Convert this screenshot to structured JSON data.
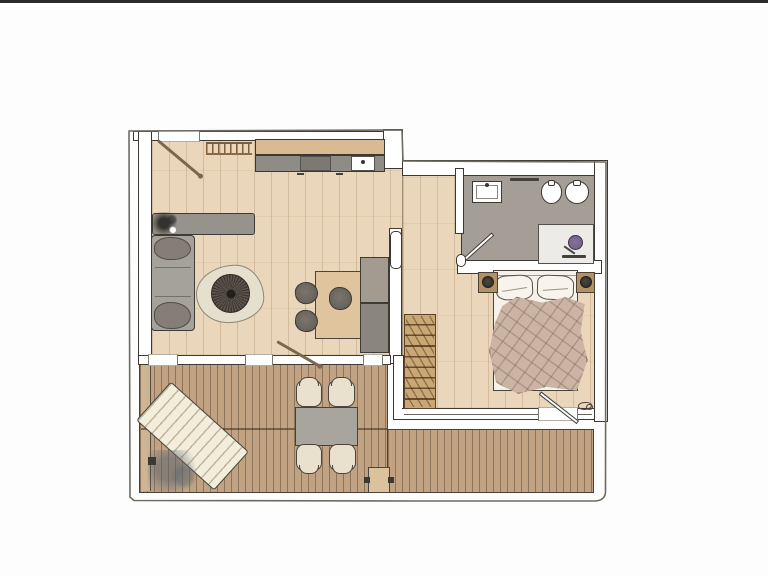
{
  "meta": {
    "description": "hand-drawn color floor plan of a one-bedroom apartment with terrace deck",
    "no_visible_text": true
  },
  "colors": {
    "ink": "#3c3833",
    "pencil": "#6f6b62",
    "band": "#2c2b29",
    "floor": "#ead7bb",
    "bath": "#a59e96",
    "deck": "#c1a384",
    "deck_light": "#d0b795",
    "counter": "#d8ba93",
    "cabinet": "#8f8c87",
    "cooktop": "#7c7973",
    "gray_furn": "#96938d",
    "sofa": "#a5a19b",
    "cushion": "#847e76",
    "rug": "#e5dfcd",
    "wood_table": "#dfc49e",
    "cab_up": "#a39a90",
    "cab_low": "#8a857e",
    "wardrobe": "#c9a876",
    "wardrobe_line": "#5b4127",
    "bed": "#f6f2ea",
    "blanket": "#cbb4a4",
    "nightstand": "#b29165",
    "shower": "#edebe7",
    "shower_head": "#6f5d80",
    "out_chair": "#e9e1ce",
    "out_table": "#a8a49e",
    "lounger": "#f3eddc",
    "step": "#dcc29c",
    "door_wood": "#7a6750"
  },
  "paths": {
    "building_outline": "M129,131 L130,497 L134,500.5 L420,501 L594,501 Q605,501 605.5,492 L606,162 L403,161 L402,130 Z"
  },
  "scene": {
    "items": [
      {
        "name": "living-room-floor",
        "cls": "floor-wood",
        "x": 151,
        "y": 139,
        "w": 252,
        "h": 217
      },
      {
        "name": "bedroom-hall-floor",
        "cls": "floor-wood",
        "x": 402,
        "y": 175,
        "w": 193,
        "h": 234
      },
      {
        "name": "bathroom-floor",
        "cls": "floor-bath",
        "x": 461,
        "y": 175,
        "w": 134,
        "h": 90
      },
      {
        "name": "deck-left",
        "cls": "deck",
        "x": 139,
        "y": 363,
        "w": 249,
        "h": 130
      },
      {
        "name": "deck-right",
        "cls": "deck",
        "x": 387,
        "y": 429,
        "w": 207,
        "h": 64
      },
      {
        "name": "deck-margin-board",
        "cls": "deck-margin",
        "x": 141,
        "y": 365,
        "w": 10,
        "h": 126
      },
      {
        "name": "deck-seam",
        "cls": "seam-line",
        "x": 141,
        "y": 428,
        "w": 246,
        "h": 2
      },
      {
        "name": "wall-top-living",
        "cls": "wall",
        "x": 133,
        "y": 131,
        "w": 270,
        "h": 10
      },
      {
        "name": "entry-opening",
        "cls": "wall-gap",
        "x": 158,
        "y": 130,
        "w": 42,
        "h": 12
      },
      {
        "name": "wall-left",
        "cls": "wall",
        "x": 138,
        "y": 131,
        "w": 14,
        "h": 233
      },
      {
        "name": "wall-step-top",
        "cls": "wall",
        "x": 383,
        "y": 129,
        "w": 20,
        "h": 40
      },
      {
        "name": "wall-top-right",
        "cls": "wall",
        "x": 402,
        "y": 160,
        "w": 206,
        "h": 16
      },
      {
        "name": "wall-east",
        "cls": "wall",
        "x": 594,
        "y": 160,
        "w": 14,
        "h": 262
      },
      {
        "name": "wall-bathroom-west",
        "cls": "wall",
        "x": 455,
        "y": 168,
        "w": 9,
        "h": 66
      },
      {
        "name": "wall-bathroom-south",
        "cls": "wall",
        "x": 457,
        "y": 260,
        "w": 145,
        "h": 14
      },
      {
        "name": "wall-living-east",
        "cls": "wall",
        "x": 389,
        "y": 228,
        "w": 13,
        "h": 136
      },
      {
        "name": "wall-bedroom-west",
        "cls": "wall",
        "x": 393,
        "y": 355,
        "w": 11,
        "h": 65
      },
      {
        "name": "wall-living-south",
        "cls": "wall",
        "x": 138,
        "y": 355,
        "w": 253,
        "h": 10
      },
      {
        "name": "window-left",
        "cls": "wall-gap",
        "x": 148,
        "y": 354,
        "w": 30,
        "h": 12
      },
      {
        "name": "window-middle",
        "cls": "wall-gap",
        "x": 245,
        "y": 354,
        "w": 28,
        "h": 12
      },
      {
        "name": "window-right",
        "cls": "wall-gap",
        "x": 363,
        "y": 354,
        "w": 20,
        "h": 12
      },
      {
        "name": "wall-bedroom-south-glazing",
        "cls": "wall-glass",
        "x": 402,
        "y": 408,
        "w": 192,
        "h": 12
      },
      {
        "name": "bedroom-terrace-opening",
        "cls": "wall-gap",
        "x": 538,
        "y": 407,
        "w": 40,
        "h": 14
      },
      {
        "name": "kitchen-counter",
        "cls": "counter",
        "x": 255,
        "y": 139,
        "w": 130,
        "h": 16
      },
      {
        "name": "kitchen-cabinet-front",
        "cls": "cabinet",
        "x": 255,
        "y": 155,
        "w": 130,
        "h": 17
      },
      {
        "name": "kitchen-cooktop",
        "cls": "cooktop",
        "x": 300,
        "y": 156,
        "w": 31,
        "h": 15
      },
      {
        "name": "kitchen-sink",
        "cls": "sink",
        "x": 351,
        "y": 156,
        "w": 24,
        "h": 15
      },
      {
        "name": "cabinet-handle-left",
        "cls": "dash",
        "x": 297,
        "y": 173,
        "w": 7,
        "h": 2
      },
      {
        "name": "cabinet-handle-right",
        "cls": "dash",
        "x": 336,
        "y": 173,
        "w": 7,
        "h": 2
      },
      {
        "name": "coat-rack",
        "cls": "coat-rack",
        "x": 206,
        "y": 142,
        "w": 46,
        "h": 13
      },
      {
        "name": "entry-door-leaf",
        "cls": "door-leaf-wood",
        "x": 158,
        "y": 139,
        "w": 55,
        "h": 3,
        "rot": 40
      },
      {
        "name": "sideboard",
        "cls": "gray-furn",
        "x": 152,
        "y": 213,
        "w": 103,
        "h": 22
      },
      {
        "name": "sideboard-plant",
        "cls": "plant-dark",
        "x": 153,
        "y": 212,
        "w": 26,
        "h": 23
      },
      {
        "name": "sofa",
        "cls": "sofa",
        "x": 151,
        "y": 235,
        "w": 44,
        "h": 96
      },
      {
        "name": "sofa-cushion-top",
        "cls": "cushion",
        "x": 154,
        "y": 237,
        "w": 37,
        "h": 23
      },
      {
        "name": "sofa-cushion-bottom",
        "cls": "cushion",
        "x": 154,
        "y": 302,
        "w": 37,
        "h": 27
      },
      {
        "name": "rug",
        "cls": "rug",
        "x": 196,
        "y": 265,
        "w": 68,
        "h": 58,
        "rot": -3
      },
      {
        "name": "coffee-table",
        "cls": "coffee",
        "x": 211,
        "y": 274,
        "w": 39,
        "h": 39
      },
      {
        "name": "dining-table",
        "cls": "wood-table",
        "x": 315,
        "y": 271,
        "w": 47,
        "h": 68
      },
      {
        "name": "dining-chair-1",
        "cls": "chair-dark",
        "x": 295,
        "y": 282,
        "w": 23,
        "h": 22,
        "rot": -8
      },
      {
        "name": "dining-chair-2",
        "cls": "chair-dark",
        "x": 295,
        "y": 310,
        "w": 23,
        "h": 22,
        "rot": 6
      },
      {
        "name": "dining-chair-3",
        "cls": "chair-dark",
        "x": 329,
        "y": 287,
        "w": 23,
        "h": 23
      },
      {
        "name": "tall-cabinet-upper",
        "cls": "cab-up",
        "x": 360,
        "y": 257,
        "w": 29,
        "h": 46
      },
      {
        "name": "tall-cabinet-lower",
        "cls": "cab-low",
        "x": 360,
        "y": 303,
        "w": 29,
        "h": 50
      },
      {
        "name": "pocket-door",
        "cls": "door-white",
        "x": 390,
        "y": 231,
        "w": 12,
        "h": 38
      },
      {
        "name": "terrace-door-leaf",
        "cls": "door-leaf-wood",
        "x": 277,
        "y": 340,
        "w": 49,
        "h": 3,
        "rot": 30
      },
      {
        "name": "wardrobe-rack",
        "cls": "wardrobe",
        "x": 404,
        "y": 314,
        "w": 32,
        "h": 95
      },
      {
        "name": "bed",
        "cls": "bed",
        "x": 493,
        "y": 270,
        "w": 85,
        "h": 121
      },
      {
        "name": "pillow-left",
        "cls": "pillow",
        "x": 496,
        "y": 275,
        "w": 37,
        "h": 25,
        "rot": -3
      },
      {
        "name": "pillow-right",
        "cls": "pillow",
        "x": 537,
        "y": 275,
        "w": 37,
        "h": 25,
        "rot": 2
      },
      {
        "name": "bed-blanket",
        "cls": "blanket",
        "x": 489,
        "y": 296,
        "w": 98,
        "h": 97,
        "rot": -2
      },
      {
        "name": "nightstand-left",
        "cls": "nightstand",
        "x": 478,
        "y": 272,
        "w": 20,
        "h": 21
      },
      {
        "name": "nightstand-lamp-left",
        "cls": "lamp",
        "x": 482,
        "y": 276,
        "w": 12,
        "h": 12
      },
      {
        "name": "nightstand-right",
        "cls": "nightstand",
        "x": 576,
        "y": 272,
        "w": 19,
        "h": 21
      },
      {
        "name": "nightstand-lamp-right",
        "cls": "lamp",
        "x": 580,
        "y": 276,
        "w": 12,
        "h": 12
      },
      {
        "name": "bedroom-terrace-door-leaf",
        "cls": "door-leaf-white",
        "x": 540,
        "y": 391,
        "w": 48,
        "h": 4,
        "rot": 38
      },
      {
        "name": "door-hardware-mark",
        "cls": "squiggle",
        "x": 578,
        "y": 402,
        "w": 14,
        "h": 8
      },
      {
        "name": "washbasin",
        "cls": "basin",
        "x": 472,
        "y": 181,
        "w": 30,
        "h": 22
      },
      {
        "name": "towel-rail",
        "cls": "dark-dash",
        "x": 510,
        "y": 178,
        "w": 29,
        "h": 3
      },
      {
        "name": "bidet",
        "cls": "fixture-oval",
        "x": 541,
        "y": 181,
        "w": 21,
        "h": 23
      },
      {
        "name": "toilet",
        "cls": "fixture-oval",
        "x": 565,
        "y": 181,
        "w": 24,
        "h": 23
      },
      {
        "name": "shower-tray",
        "cls": "shower",
        "x": 538,
        "y": 224,
        "w": 56,
        "h": 40
      },
      {
        "name": "shower-head",
        "cls": "shower-head",
        "x": 568,
        "y": 235,
        "w": 15,
        "h": 15
      },
      {
        "name": "shower-base-line",
        "cls": "dark-dash",
        "x": 562,
        "y": 255,
        "w": 24,
        "h": 3
      },
      {
        "name": "bathroom-door-leaf",
        "cls": "door-leaf-white",
        "x": 464,
        "y": 258,
        "w": 39,
        "h": 4,
        "rot": -42
      },
      {
        "name": "bathroom-threshold",
        "cls": "door-white",
        "x": 456,
        "y": 254,
        "w": 10,
        "h": 13
      },
      {
        "name": "outdoor-table",
        "cls": "out-table",
        "x": 295,
        "y": 407,
        "w": 63,
        "h": 39
      },
      {
        "name": "outdoor-chair-top-left",
        "cls": "chair-out up",
        "x": 296,
        "y": 380,
        "w": 26,
        "h": 27
      },
      {
        "name": "outdoor-chair-top-right",
        "cls": "chair-out up",
        "x": 328,
        "y": 380,
        "w": 27,
        "h": 27
      },
      {
        "name": "outdoor-chair-bottom-left",
        "cls": "chair-out dn",
        "x": 296,
        "y": 444,
        "w": 26,
        "h": 27
      },
      {
        "name": "outdoor-chair-bottom-right",
        "cls": "chair-out dn",
        "x": 329,
        "y": 444,
        "w": 27,
        "h": 27
      },
      {
        "name": "sun-lounger",
        "cls": "lounger",
        "x": 140,
        "y": 410,
        "w": 105,
        "h": 52,
        "rot": 42
      },
      {
        "name": "deck-plant",
        "cls": "plant-soft",
        "x": 148,
        "y": 450,
        "w": 52,
        "h": 42
      },
      {
        "name": "deck-plant-pot",
        "cls": "dot-dark",
        "x": 148,
        "y": 457,
        "w": 8,
        "h": 8
      },
      {
        "name": "deck-step",
        "cls": "step",
        "x": 368,
        "y": 467,
        "w": 22,
        "h": 26
      },
      {
        "name": "step-dot-left",
        "cls": "dot-dark",
        "x": 364,
        "y": 477,
        "w": 6,
        "h": 6
      },
      {
        "name": "step-dot-right",
        "cls": "dot-dark",
        "x": 388,
        "y": 477,
        "w": 6,
        "h": 6
      }
    ]
  }
}
